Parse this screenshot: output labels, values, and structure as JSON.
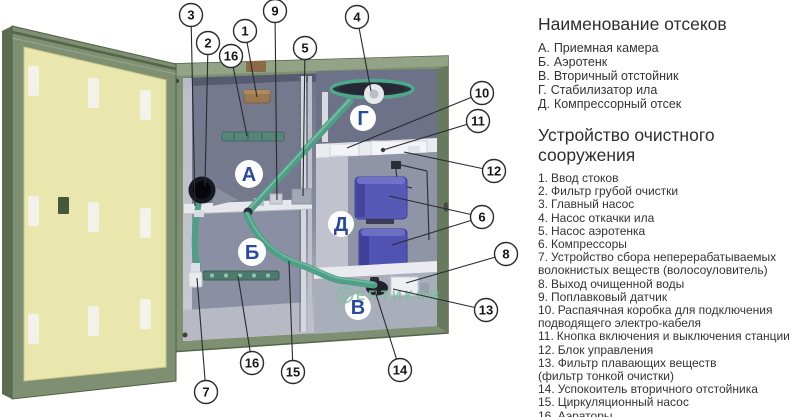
{
  "sections": {
    "compartments": {
      "title": "Наименование отсеков",
      "items": [
        {
          "key": "А.",
          "label": "Приемная камера"
        },
        {
          "key": "Б.",
          "label": "Аэротенк"
        },
        {
          "key": "В.",
          "label": "Вторичный отстойник"
        },
        {
          "key": "Г.",
          "label": "Стабилизатор ила"
        },
        {
          "key": "Д.",
          "label": "Компрессорный отсек"
        }
      ]
    },
    "device": {
      "title": "Устройство очистного сооружения",
      "items": [
        {
          "num": "1.",
          "label": "Ввод стоков"
        },
        {
          "num": "2.",
          "label": "Фильтр грубой очистки"
        },
        {
          "num": "3.",
          "label": "Главный насос"
        },
        {
          "num": "4.",
          "label": "Насос откачки ила"
        },
        {
          "num": "5.",
          "label": "Насос аэротенка"
        },
        {
          "num": "6.",
          "label": "Компрессоры"
        },
        {
          "num": "7.",
          "label": "Устройство сбора неперерабатываемых\nволокнистых веществ (волосоуловитель)"
        },
        {
          "num": "8.",
          "label": "Выход очищенной воды"
        },
        {
          "num": "9.",
          "label": "Поплавковый датчик"
        },
        {
          "num": "10.",
          "label": "Распаячная коробка для подключения\nподводящего электро-кабеля"
        },
        {
          "num": "11.",
          "label": "Кнопка включения и выключения станции"
        },
        {
          "num": "12.",
          "label": "Блок управления"
        },
        {
          "num": "13.",
          "label": "Фильтр плавающих веществ\n(фильтр тонкой очистки)"
        },
        {
          "num": "14.",
          "label": "Успокоитель вторичного отстойника"
        },
        {
          "num": "15.",
          "label": "Циркуляционный насос"
        },
        {
          "num": "16.",
          "label": "Аэраторы"
        }
      ]
    }
  },
  "diagram": {
    "letters": {
      "a": "А",
      "b": "Б",
      "v": "В",
      "g": "Г",
      "d": "Д"
    },
    "callouts": {
      "c1": "1",
      "c2": "2",
      "c3": "3",
      "c4": "4",
      "c5": "5",
      "c6": "6",
      "c7": "7",
      "c8": "8",
      "c9": "9",
      "c10": "10",
      "c11": "11",
      "c12": "12",
      "c13": "13",
      "c14": "14",
      "c15": "15",
      "c16a": "16",
      "c16b": "16"
    },
    "watermark": {
      "symbol": "С",
      "text": "ЕПТИКОВ"
    },
    "colors": {
      "cabinet_green": "#7e8f72",
      "door_panel_yellow": "#e9e6ae",
      "interior_grey": "#82879b",
      "letter_blue": "#2a4a9f",
      "pipe_green": "#4f9f87",
      "compressor_blue": "#5659b6",
      "inlet_brown": "#9a7850",
      "watermark_green": "#7cc09c"
    }
  }
}
